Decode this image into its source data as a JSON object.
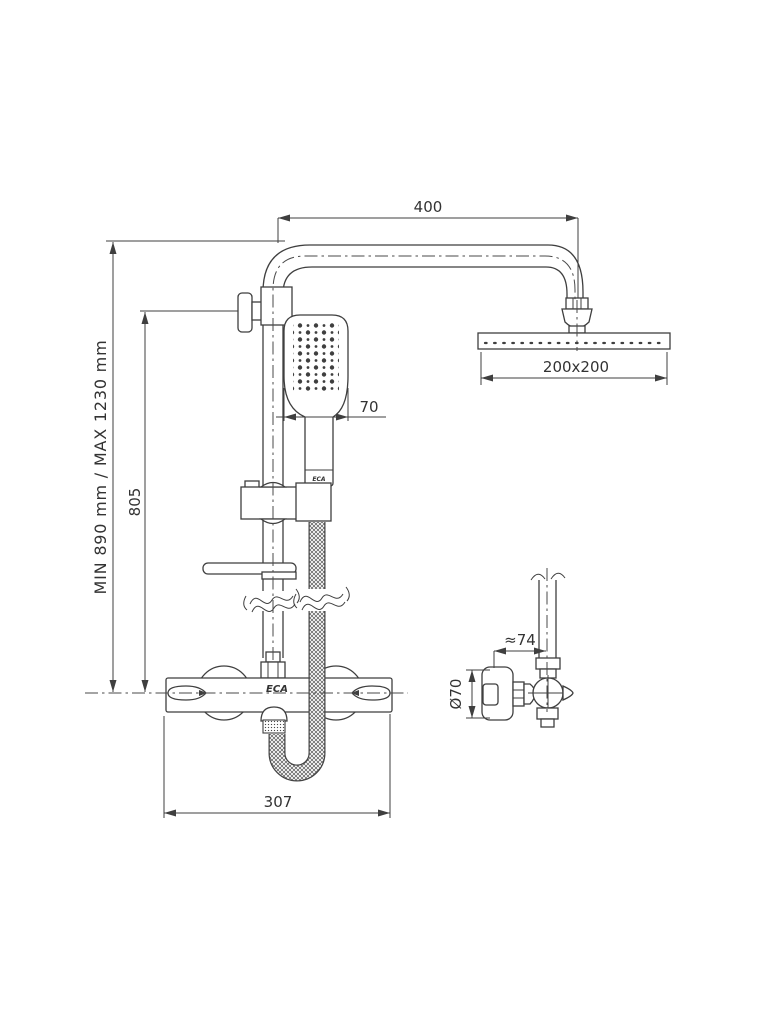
{
  "background_color": "#ffffff",
  "line_color": "#3f3f3f",
  "drawing": {
    "dims": {
      "arm_reach": "400",
      "head_size": "200x200",
      "hand_shower_width": "70",
      "height_range": "MIN 890 mm / MAX 1230 mm",
      "rail_height": "805",
      "mixer_width": "307",
      "wall_distance": "≈74",
      "handle_diameter": "Ø70"
    },
    "brand": {
      "body": "ECA",
      "handle": "ECA"
    }
  }
}
